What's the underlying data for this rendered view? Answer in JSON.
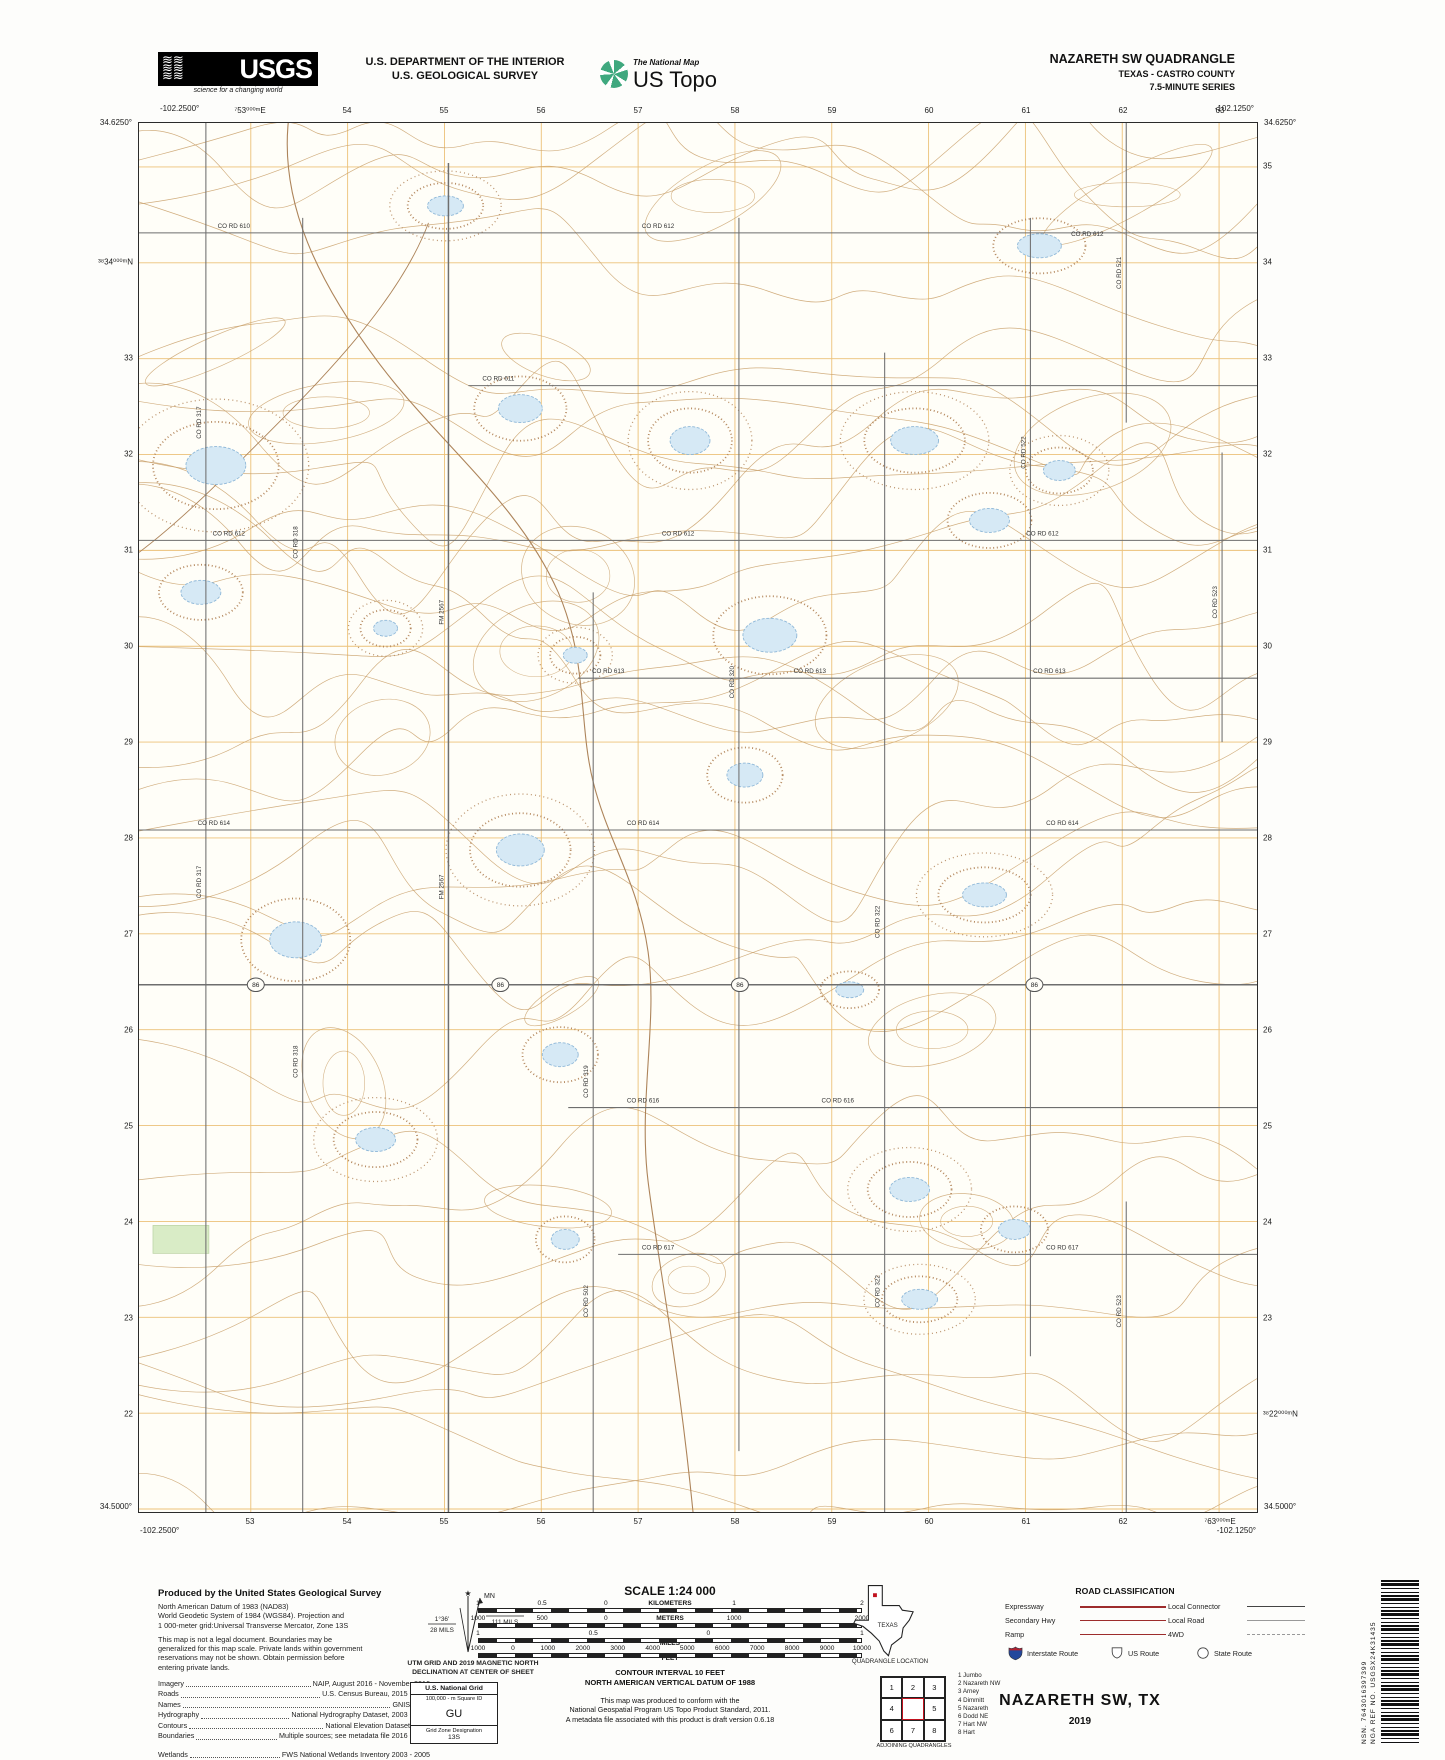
{
  "header": {
    "usgs": {
      "logo_text": "USGS",
      "tagline": "science for a changing world"
    },
    "dept_line1": "U.S. DEPARTMENT OF THE INTERIOR",
    "dept_line2": "U.S. GEOLOGICAL SURVEY",
    "ustopo": {
      "brand": "The National Map",
      "product": "US Topo"
    },
    "quad_name": "NAZARETH SW QUADRANGLE",
    "quad_county": "TEXAS - CASTRO COUNTY",
    "quad_series": "7.5-MINUTE SERIES"
  },
  "map": {
    "corners": {
      "tl_lat": "34.6250°",
      "tl_lng": "-102.2500°",
      "tr_lat": "34.6250°",
      "tr_lng": "-102.1250°",
      "bl_lat": "34.5000°",
      "bl_lng": "-102.2500°",
      "br_lat": "34.5000°",
      "br_lng": "-102.1250°"
    },
    "top_labels": [
      "⁷53⁰⁰⁰ᵐE",
      "54",
      "55",
      "56",
      "57",
      "58",
      "59",
      "60",
      "61",
      "62",
      "63"
    ],
    "bottom_labels": [
      "53",
      "54",
      "55",
      "56",
      "57",
      "58",
      "59",
      "60",
      "61",
      "62",
      "⁷63⁰⁰⁰ᵐE"
    ],
    "left_labels": [
      "³⁸34⁰⁰⁰ᵐN",
      "33",
      "32",
      "31",
      "30",
      "29",
      "28",
      "27",
      "26",
      "25",
      "24",
      "23",
      "22"
    ],
    "right_labels": [
      "35",
      "34",
      "33",
      "32",
      "31",
      "30",
      "29",
      "28",
      "27",
      "26",
      "25",
      "24",
      "23",
      "³⁸22⁰⁰⁰ᵐN"
    ],
    "vertical_roads": [
      {
        "x": 67,
        "y1": 0,
        "y2": 1391
      },
      {
        "x": 164,
        "y1": 95,
        "y2": 1391
      },
      {
        "x": 310,
        "y1": 40,
        "y2": 1391,
        "w": 1.5
      },
      {
        "x": 455,
        "y1": 470,
        "y2": 1391
      },
      {
        "x": 601,
        "y1": 95,
        "y2": 1330
      },
      {
        "x": 747,
        "y1": 230,
        "y2": 1391
      },
      {
        "x": 893,
        "y1": 95,
        "y2": 1235
      },
      {
        "x": 989,
        "y1": 0,
        "y2": 300
      },
      {
        "x": 989,
        "y1": 1080,
        "y2": 1391
      },
      {
        "x": 1085,
        "y1": 330,
        "y2": 620
      }
    ],
    "horizontal_roads": [
      {
        "y": 110,
        "x1": 0,
        "x2": 1120
      },
      {
        "y": 263,
        "x1": 330,
        "x2": 1120
      },
      {
        "y": 418,
        "x1": 0,
        "x2": 1120
      },
      {
        "y": 556,
        "x1": 440,
        "x2": 1120
      },
      {
        "y": 708,
        "x1": 0,
        "x2": 1120
      },
      {
        "y": 863,
        "x1": 0,
        "x2": 1120,
        "w": 1.6
      },
      {
        "y": 986,
        "x1": 430,
        "x2": 1120
      },
      {
        "y": 1133,
        "x1": 480,
        "x2": 1120
      }
    ],
    "road_labels": [
      {
        "t": "CO RD 610",
        "x": 95,
        "y": 105,
        "r": 0
      },
      {
        "t": "CO RD 612",
        "x": 520,
        "y": 105,
        "r": 0
      },
      {
        "t": "CO RD 612",
        "x": 950,
        "y": 113,
        "r": 0
      },
      {
        "t": "CO RD 611",
        "x": 360,
        "y": 258,
        "r": 0
      },
      {
        "t": "CO RD 612",
        "x": 90,
        "y": 413,
        "r": 0
      },
      {
        "t": "CO RD 612",
        "x": 540,
        "y": 413,
        "r": 0
      },
      {
        "t": "CO RD 612",
        "x": 905,
        "y": 413,
        "r": 0
      },
      {
        "t": "CO RD 613",
        "x": 470,
        "y": 551,
        "r": 0
      },
      {
        "t": "CO RD 613",
        "x": 672,
        "y": 551,
        "r": 0
      },
      {
        "t": "CO RD 613",
        "x": 912,
        "y": 551,
        "r": 0
      },
      {
        "t": "CO RD 614",
        "x": 75,
        "y": 703,
        "r": 0
      },
      {
        "t": "CO RD 614",
        "x": 505,
        "y": 703,
        "r": 0
      },
      {
        "t": "CO RD 614",
        "x": 925,
        "y": 703,
        "r": 0
      },
      {
        "t": "CO RD 616",
        "x": 505,
        "y": 981,
        "r": 0
      },
      {
        "t": "CO RD 616",
        "x": 700,
        "y": 981,
        "r": 0
      },
      {
        "t": "CO RD 617",
        "x": 520,
        "y": 1128,
        "r": 0
      },
      {
        "t": "CO RD 617",
        "x": 925,
        "y": 1128,
        "r": 0
      },
      {
        "t": "CO RD 317",
        "x": 62,
        "y": 300,
        "r": -90
      },
      {
        "t": "CO RD 317",
        "x": 62,
        "y": 760,
        "r": -90
      },
      {
        "t": "CO RD 318",
        "x": 159,
        "y": 420,
        "r": -90
      },
      {
        "t": "CO RD 318",
        "x": 159,
        "y": 940,
        "r": -90
      },
      {
        "t": "FM 2567",
        "x": 305,
        "y": 490,
        "r": -90
      },
      {
        "t": "FM 2567",
        "x": 305,
        "y": 765,
        "r": -90
      },
      {
        "t": "CO RD 319",
        "x": 450,
        "y": 960,
        "r": -90
      },
      {
        "t": "CO RD 502",
        "x": 450,
        "y": 1180,
        "r": -90
      },
      {
        "t": "CO RD 320",
        "x": 596,
        "y": 560,
        "r": -90
      },
      {
        "t": "CO RD 322",
        "x": 742,
        "y": 800,
        "r": -90
      },
      {
        "t": "CO RD 322",
        "x": 742,
        "y": 1170,
        "r": -90
      },
      {
        "t": "CO RD 522",
        "x": 888,
        "y": 330,
        "r": -90
      },
      {
        "t": "CO RD 521",
        "x": 984,
        "y": 150,
        "r": -90
      },
      {
        "t": "CO RD 523",
        "x": 984,
        "y": 1190,
        "r": -90
      },
      {
        "t": "CO RD 523",
        "x": 1080,
        "y": 480,
        "r": -90
      }
    ],
    "highway_shields": [
      {
        "t": "86",
        "x": 117,
        "y": 863
      },
      {
        "t": "86",
        "x": 362,
        "y": 863
      },
      {
        "t": "86",
        "x": 602,
        "y": 863
      },
      {
        "t": "86",
        "x": 897,
        "y": 863
      }
    ],
    "ponds": [
      {
        "x": 77,
        "y": 343,
        "rx": 30,
        "ry": 19
      },
      {
        "x": 62,
        "y": 470,
        "rx": 20,
        "ry": 12
      },
      {
        "x": 307,
        "y": 83,
        "rx": 18,
        "ry": 10
      },
      {
        "x": 382,
        "y": 286,
        "rx": 22,
        "ry": 14
      },
      {
        "x": 552,
        "y": 318,
        "rx": 20,
        "ry": 14
      },
      {
        "x": 632,
        "y": 513,
        "rx": 27,
        "ry": 17
      },
      {
        "x": 777,
        "y": 318,
        "rx": 24,
        "ry": 14
      },
      {
        "x": 852,
        "y": 398,
        "rx": 20,
        "ry": 12
      },
      {
        "x": 922,
        "y": 348,
        "rx": 16,
        "ry": 10
      },
      {
        "x": 902,
        "y": 123,
        "rx": 22,
        "ry": 12
      },
      {
        "x": 437,
        "y": 533,
        "rx": 12,
        "ry": 8
      },
      {
        "x": 607,
        "y": 653,
        "rx": 18,
        "ry": 12
      },
      {
        "x": 382,
        "y": 728,
        "rx": 24,
        "ry": 16
      },
      {
        "x": 157,
        "y": 818,
        "rx": 26,
        "ry": 18
      },
      {
        "x": 847,
        "y": 773,
        "rx": 22,
        "ry": 12
      },
      {
        "x": 422,
        "y": 933,
        "rx": 18,
        "ry": 12
      },
      {
        "x": 237,
        "y": 1018,
        "rx": 20,
        "ry": 12
      },
      {
        "x": 427,
        "y": 1118,
        "rx": 14,
        "ry": 10
      },
      {
        "x": 772,
        "y": 1068,
        "rx": 20,
        "ry": 12
      },
      {
        "x": 877,
        "y": 1108,
        "rx": 16,
        "ry": 10
      },
      {
        "x": 782,
        "y": 1178,
        "rx": 18,
        "ry": 10
      },
      {
        "x": 712,
        "y": 868,
        "rx": 14,
        "ry": 8
      },
      {
        "x": 247,
        "y": 506,
        "rx": 12,
        "ry": 8
      }
    ],
    "colors": {
      "grid": "#ecc178",
      "contour": "#c9a06a",
      "contour_dark": "#b5895f",
      "water": "#d6e9f5",
      "water_line": "#8fb8d8",
      "road": "#6e6e6e",
      "stream": "#ad845a",
      "vegetation": "#d9ecc6"
    }
  },
  "footer": {
    "produced": {
      "title": "Produced by the United States Geological Survey",
      "lines": [
        "North American Datum of 1983 (NAD83)",
        "World Geodetic System of 1984 (WGS84).  Projection and",
        "1 000-meter grid:Universal Transverse Mercator, Zone 13S",
        "This map is not a legal document. Boundaries may be",
        "generalized for this map scale. Private lands within government",
        "reservations may not be shown. Obtain permission before",
        "entering private lands."
      ],
      "credits": [
        {
          "label": "Imagery",
          "value": "NAIP, August 2016 - November 2016"
        },
        {
          "label": "Roads",
          "value": "U.S. Census Bureau, 2015 - 2018"
        },
        {
          "label": "Names",
          "value": "GNIS, 2016"
        },
        {
          "label": "Hydrography",
          "value": "National Hydrography Dataset, 2003 - 2018"
        },
        {
          "label": "Contours",
          "value": "National Elevation Dataset, 2007"
        },
        {
          "label": "Boundaries",
          "value": "Multiple sources; see metadata file 2016 - 2017"
        },
        {
          "label": "Wetlands",
          "value": "FWS National Wetlands Inventory 2003 - 2005"
        }
      ]
    },
    "declination": {
      "mn": "MN",
      "star": "★",
      "gn_deg": "1°36'",
      "gn_mils": "28 MILS",
      "mn_deg": "8°14'",
      "mn_mils": "111 MILS",
      "caption1": "UTM GRID AND 2019 MAGNETIC NORTH",
      "caption2": "DECLINATION AT CENTER OF SHEET"
    },
    "usng": {
      "title": "U.S. National Grid",
      "sub": "100,000 - m Square ID",
      "square": "GU",
      "zone_label": "Grid Zone Designation",
      "zone": "13S"
    },
    "scale": {
      "title": "SCALE 1:24 000",
      "bars": [
        {
          "ticks": [
            "1",
            "0.5",
            "0",
            "1",
            "2"
          ],
          "unit": "KILOMETERS",
          "inline": true
        },
        {
          "ticks": [
            "1000",
            "500",
            "0",
            "1000",
            "2000"
          ],
          "unit": "METERS",
          "inline": true
        },
        {
          "ticks": [
            "1",
            "0.5",
            "0",
            "1"
          ],
          "unit": "MILES",
          "inline": false
        },
        {
          "ticks": [
            "1000",
            "0",
            "1000",
            "2000",
            "3000",
            "4000",
            "5000",
            "6000",
            "7000",
            "8000",
            "9000",
            "10000"
          ],
          "unit": "FEET",
          "inline": false
        }
      ]
    },
    "notes": {
      "contour1": "CONTOUR INTERVAL 10 FEET",
      "contour2": "NORTH AMERICAN VERTICAL DATUM OF 1988",
      "conform": [
        "This map was produced to conform with the",
        "National Geospatial Program US Topo Product Standard, 2011.",
        "A metadata file associated with this product is draft version 0.6.18"
      ]
    },
    "texas": {
      "label": "TEXAS",
      "caption": "QUADRANGLE LOCATION"
    },
    "adjoining": {
      "cells": [
        "1",
        "2",
        "3",
        "4",
        "",
        "5",
        "6",
        "7",
        "8"
      ],
      "names": [
        "1 Jumbo",
        "2 Nazareth NW",
        "3 Arney",
        "4 Dimmitt",
        "5 Nazareth",
        "6 Dodd NE",
        "7 Hart NW",
        "8 Hart"
      ],
      "caption": "ADJOINING QUADRANGLES"
    },
    "road_class": {
      "title": "ROAD CLASSIFICATION",
      "left": [
        {
          "label": "Expressway",
          "cls": "ln-expy"
        },
        {
          "label": "Secondary Hwy",
          "cls": "ln-sec"
        },
        {
          "label": "Ramp",
          "cls": "ln-ramp"
        }
      ],
      "right": [
        {
          "label": "Local Connector",
          "cls": "ln-conn"
        },
        {
          "label": "Local Road",
          "cls": "ln-locl"
        },
        {
          "label": "4WD",
          "cls": "ln-fwd"
        }
      ],
      "shields": [
        "Interstate Route",
        "US Route",
        "State Route"
      ]
    },
    "title_block": {
      "title": "NAZARETH SW,  TX",
      "year": "2019"
    },
    "barcode": {
      "nsn": "NSN. 7643016397399",
      "ref": "NGA REF NO. USGSX24K31435"
    }
  }
}
